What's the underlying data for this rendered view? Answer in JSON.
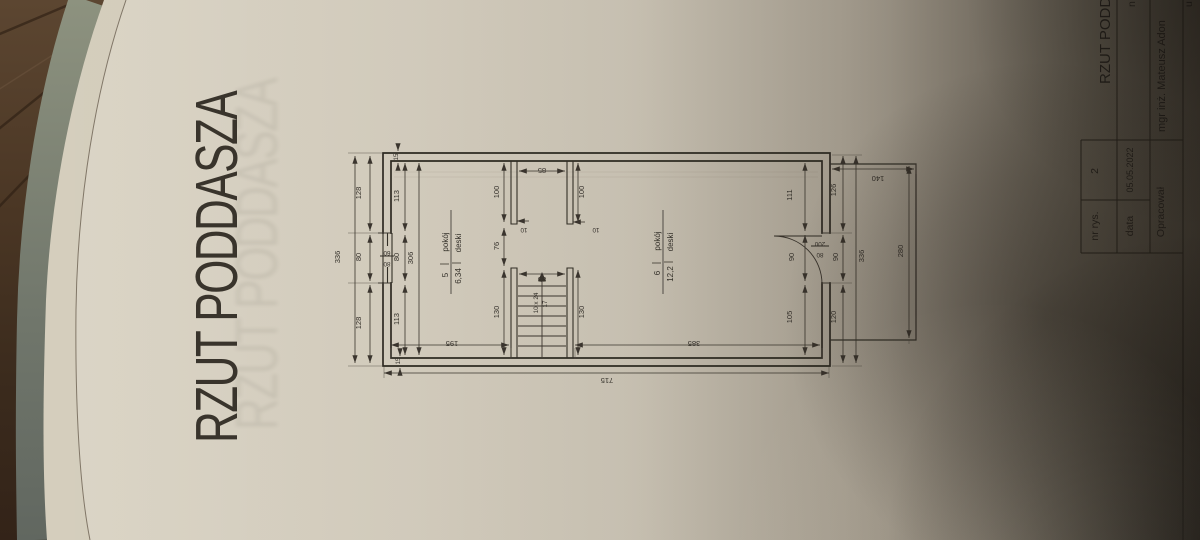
{
  "sheet_title": "RZUT PODDASZA",
  "title_block": {
    "project_title": "RZUT PODDASZA",
    "cut_fragment_2": "n",
    "cut_fragment_4": "u",
    "fields": {
      "nr_label": "nr rys.",
      "nr_value": "2",
      "date_label": "data",
      "date_value": "05.05.2022",
      "author_label": "Opracował",
      "author_value": "mgr inż. Mateusz Adon"
    }
  },
  "rooms": [
    {
      "number": "5",
      "name": "pokój",
      "area": "6,34",
      "floor": "deski"
    },
    {
      "number": "6",
      "name": "pokój",
      "area": "12,2",
      "floor": "deski"
    }
  ],
  "stairs": {
    "spec_line1": "10 x 24",
    "spec_line2": "17"
  },
  "dims": {
    "total_bottom": "715",
    "left_total": "336",
    "left_seg_top": "128",
    "left_seg_mid": "80",
    "left_seg_bot": "128",
    "window_w": "80",
    "window_h": "60",
    "room5_seg_top": "113",
    "room5_seg_mid": "80",
    "room5_seg_bot": "113",
    "room5_inner_total": "306",
    "room5_width": "195",
    "landing_width": "85",
    "stub_depth_left": "100",
    "stub_depth_right": "100",
    "stub_thk_left": "10",
    "stub_thk_right": "10",
    "corridor_width": "76",
    "stair_width": "85",
    "stair_len_left": "130",
    "stair_len_right": "130",
    "room6_width": "385",
    "room6_seg_top": "111",
    "room6_seg_mid": "90",
    "room6_seg_bot": "105",
    "right_seg_top": "126",
    "right_seg_mid": "90",
    "right_seg_bot": "120",
    "right_total": "336",
    "door_w": "80",
    "door_h": "200",
    "balcony_width": "140",
    "balcony_length": "280",
    "wall_top": "15",
    "wall_bottom": "15"
  },
  "colors": {
    "paper": "#d5cebe",
    "line": "#35312b",
    "wood": "#4a3624",
    "mat": "#7d8373"
  }
}
